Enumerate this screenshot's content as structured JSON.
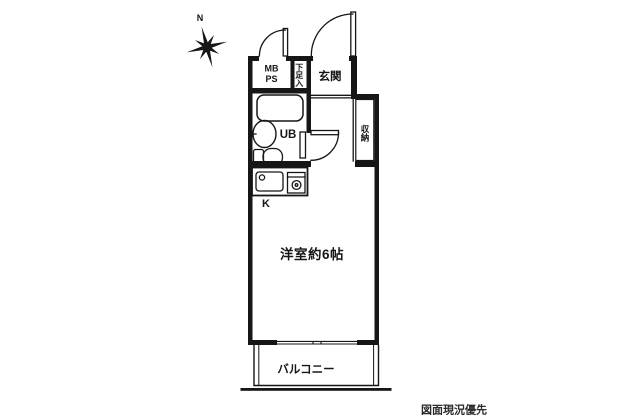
{
  "canvas": {
    "bg": "#ffffff",
    "line_color": "#161616",
    "note_color": "#2b2b2b"
  },
  "compass": {
    "north": "N"
  },
  "labels": {
    "mb": "MB",
    "ps": "PS",
    "shoe_cabinet": "下足入",
    "entrance": "玄関",
    "unit_bath": "UB",
    "storage": "収納",
    "kitchen": "K",
    "main_room": "洋室約6帖",
    "balcony": "バルコニー"
  },
  "note": {
    "text": "図面現況優先"
  }
}
